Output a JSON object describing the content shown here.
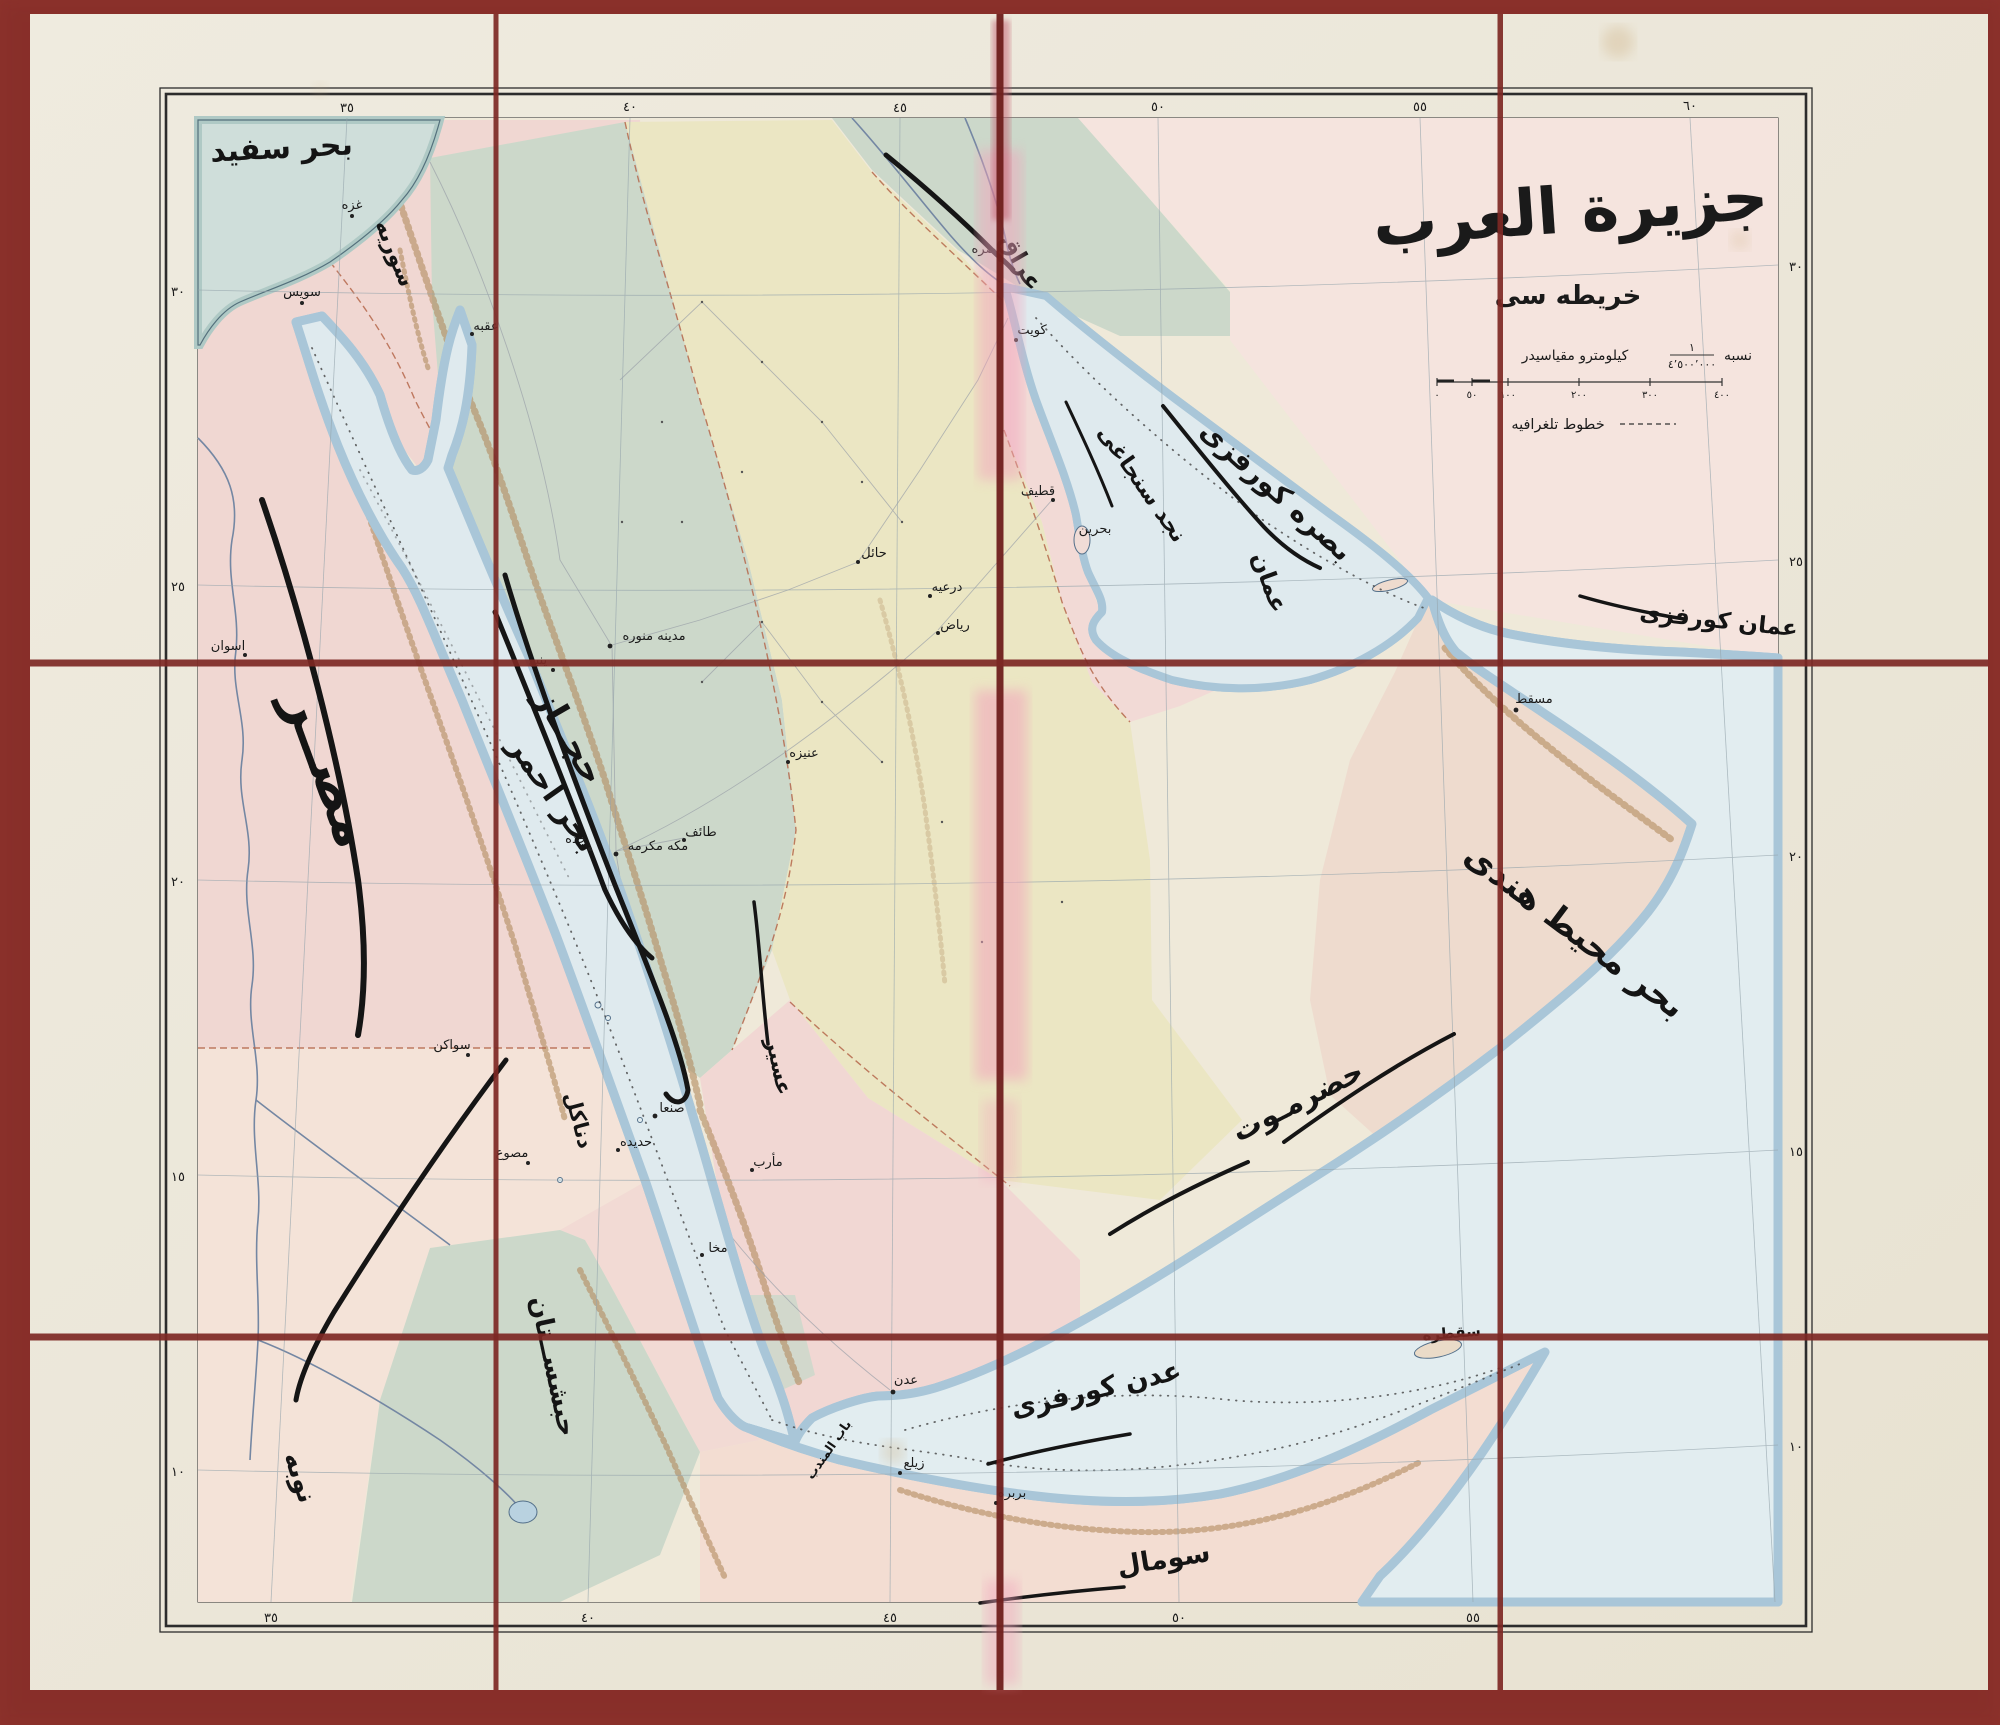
{
  "map": {
    "title": "جزيرة العرب",
    "subtitle": "خريطه سى",
    "scale": {
      "prefix": "نسبه",
      "fraction_numerator": "١",
      "fraction_denominator": "٤٬٥٠٠٬٠٠٠",
      "suffix": "كيلومترو مقياسيدر",
      "bar_ticks": [
        "٠",
        "٥٠",
        "١٠٠",
        "٢٠٠",
        "٣٠٠",
        "٤٠٠"
      ],
      "telegraph_legend": "خطوط تلغرافيه"
    },
    "seas": {
      "mediterranean": "بحر سفيد",
      "red_sea": "بحر احمر",
      "persian_gulf": "بصره كورفزى",
      "gulf_of_oman": "عمان كورفزى",
      "gulf_of_aden": "عدن كورفزى",
      "indian_ocean": "بحر محيط هندى",
      "bab_el_mandeb": "باب المندب"
    },
    "regions": {
      "iraq": "عراق",
      "syria": "سوريه",
      "najd_sanjak": "نجد سنجاغى",
      "hejaz": "حجــاز",
      "asir": "عسير",
      "oman": "عمان",
      "hadhramaut": "حضرمـوت",
      "egypt": "مصــر",
      "nubia": "نوبه",
      "danakil": "دناكل",
      "abyssinia": "حبشســتان",
      "somal": "سومال",
      "socotra": "سقطره"
    },
    "cities": [
      {
        "label": "سويس"
      },
      {
        "label": "غزه"
      },
      {
        "label": "عقبه"
      },
      {
        "label": "مدينه منوره"
      },
      {
        "label": "ينبع"
      },
      {
        "label": "جده"
      },
      {
        "label": "مكه مكرمه"
      },
      {
        "label": "طائف"
      },
      {
        "label": "صنعا"
      },
      {
        "label": "حديده"
      },
      {
        "label": "مخا"
      },
      {
        "label": "عدن"
      },
      {
        "label": "مأرب"
      },
      {
        "label": "درعيه"
      },
      {
        "label": "رياض"
      },
      {
        "label": "عنيزه"
      },
      {
        "label": "حائل"
      },
      {
        "label": "بحرين"
      },
      {
        "label": "قطيف"
      },
      {
        "label": "مسقط"
      },
      {
        "label": "اسوان"
      },
      {
        "label": "سواكن"
      },
      {
        "label": "مصوع"
      },
      {
        "label": "زيلع"
      },
      {
        "label": "بربره"
      },
      {
        "label": "بصره"
      },
      {
        "label": "كويت"
      }
    ],
    "graticule": {
      "top": [
        "٣٥",
        "٤٠",
        "٤٥",
        "٥٠",
        "٥٥",
        "٦٠"
      ],
      "bottom": [
        "٣٥",
        "٤٠",
        "٤٥",
        "٥٠",
        "٥٥"
      ],
      "left": [
        "٣٠",
        "٢٥",
        "٢٠",
        "١٥",
        "١٠"
      ],
      "right": [
        "٣٠",
        "٢٥",
        "٢٠",
        "١٥",
        "١٠"
      ]
    }
  }
}
